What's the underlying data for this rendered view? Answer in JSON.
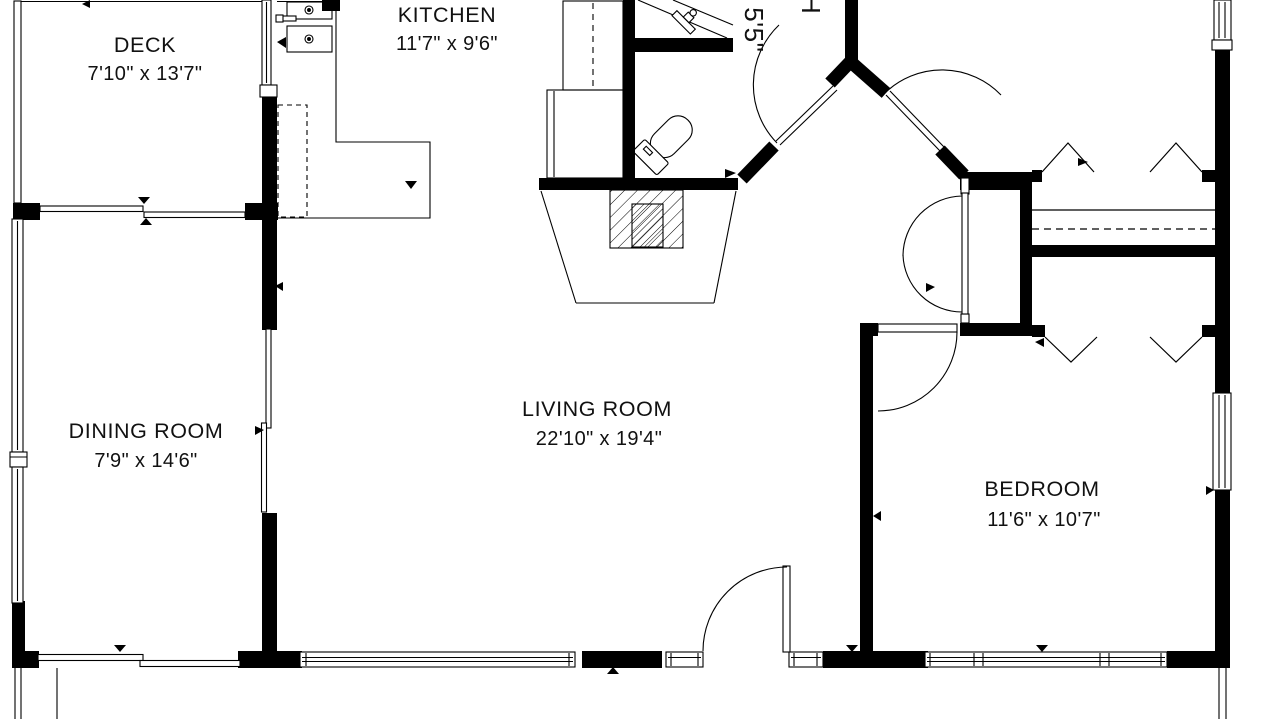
{
  "plan": {
    "type": "floor-plan",
    "colors": {
      "wall": "#000000",
      "background": "#ffffff",
      "text": "#111111"
    },
    "rooms": [
      {
        "id": "deck",
        "name": "DECK",
        "dims": "7'10\" x 13'7\""
      },
      {
        "id": "kitchen",
        "name": "KITCHEN",
        "dims": "11'7\" x 9'6\""
      },
      {
        "id": "dining_room",
        "name": "DINING ROOM",
        "dims": "7'9\" x 14'6\""
      },
      {
        "id": "living_room",
        "name": "LIVING ROOM",
        "dims": "22'10\" x 19'4\""
      },
      {
        "id": "bedroom",
        "name": "BEDROOM",
        "dims": "11'6\" x 10'7\""
      },
      {
        "id": "bath_cut_off_at_top",
        "rotated": true,
        "name_fragment": "H",
        "dims_fragment": "x 5'5\""
      }
    ]
  }
}
